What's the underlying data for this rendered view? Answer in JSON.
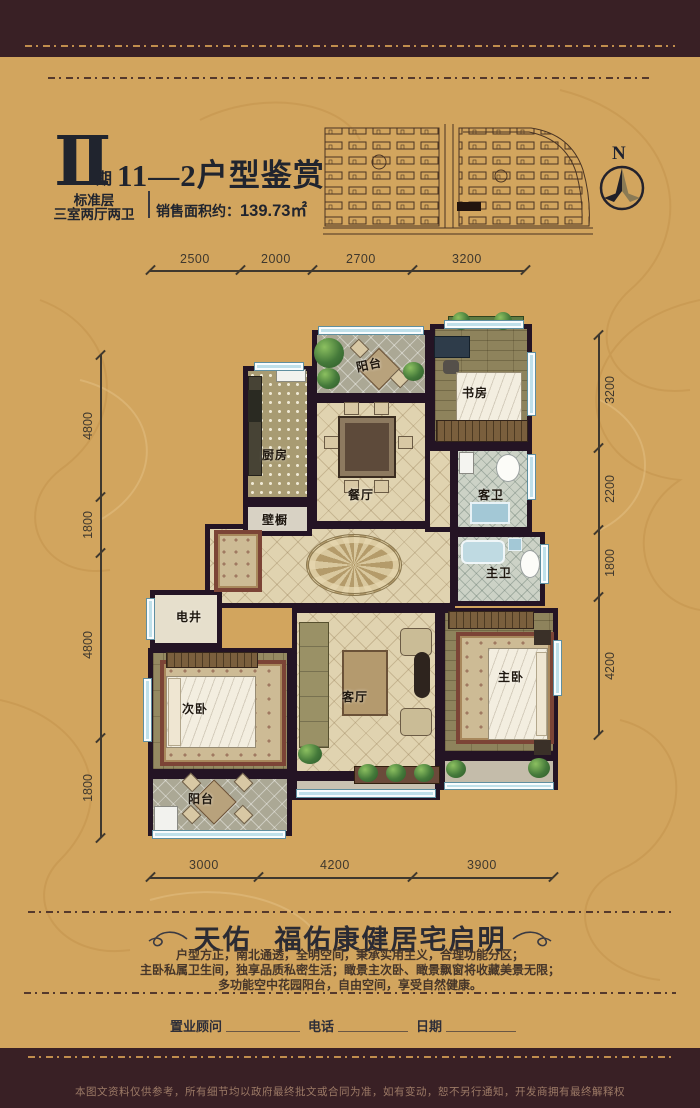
{
  "colors": {
    "gold_bg": "#d2a55e",
    "border_band": "#392025",
    "wall": "#241424",
    "window_blue": "#bfe0ea",
    "title_ink": "#20242e",
    "gold_line": "#c08d4d",
    "disclaimer_ink": "#9c7a66"
  },
  "header": {
    "phase_numeral": "Ⅱ",
    "phase_char": "期",
    "title": "11—2户型鉴赏",
    "floor_type": "标准层",
    "layout_type": "三室两厅两卫",
    "area_label": "销售面积约：",
    "area_value": "139.73㎡",
    "north_label": "N"
  },
  "dimensions": {
    "top": [
      "2500",
      "2000",
      "2700",
      "3200"
    ],
    "left": [
      "4800",
      "1800",
      "4800",
      "1800"
    ],
    "right": [
      "3200",
      "2200",
      "1800",
      "4200"
    ],
    "bottom": [
      "3000",
      "4200",
      "3900"
    ]
  },
  "rooms": {
    "balcony_top": "阳台",
    "kitchen": "厨房",
    "study": "书房",
    "dining": "餐厅",
    "guest_bath": "客卫",
    "closet": "壁橱",
    "master_bath": "主卫",
    "shaft": "电井",
    "second_bedroom": "次卧",
    "living": "客厅",
    "master_bedroom": "主卧",
    "balcony_bottom": "阳台"
  },
  "footer": {
    "slogan_a": "天佑",
    "slogan_b": "福佑康健居宅启明",
    "desc": [
      "户型方正，南北通透，全明空间，秉承实用主义，合理功能分区；",
      "主卧私属卫生间，独享品质私密生活；瞰景主次卧、瞰景飘窗将收藏美景无限；",
      "多功能空中花园阳台，自由空间，享受自然健康。"
    ],
    "advisor_label": "置业顾问",
    "phone_label": "电话",
    "date_label": "日期",
    "disclaimer": "本图文资料仅供参考，所有细节均以政府最终批文或合同为准，如有变动，恕不另行通知，开发商拥有最终解释权"
  }
}
